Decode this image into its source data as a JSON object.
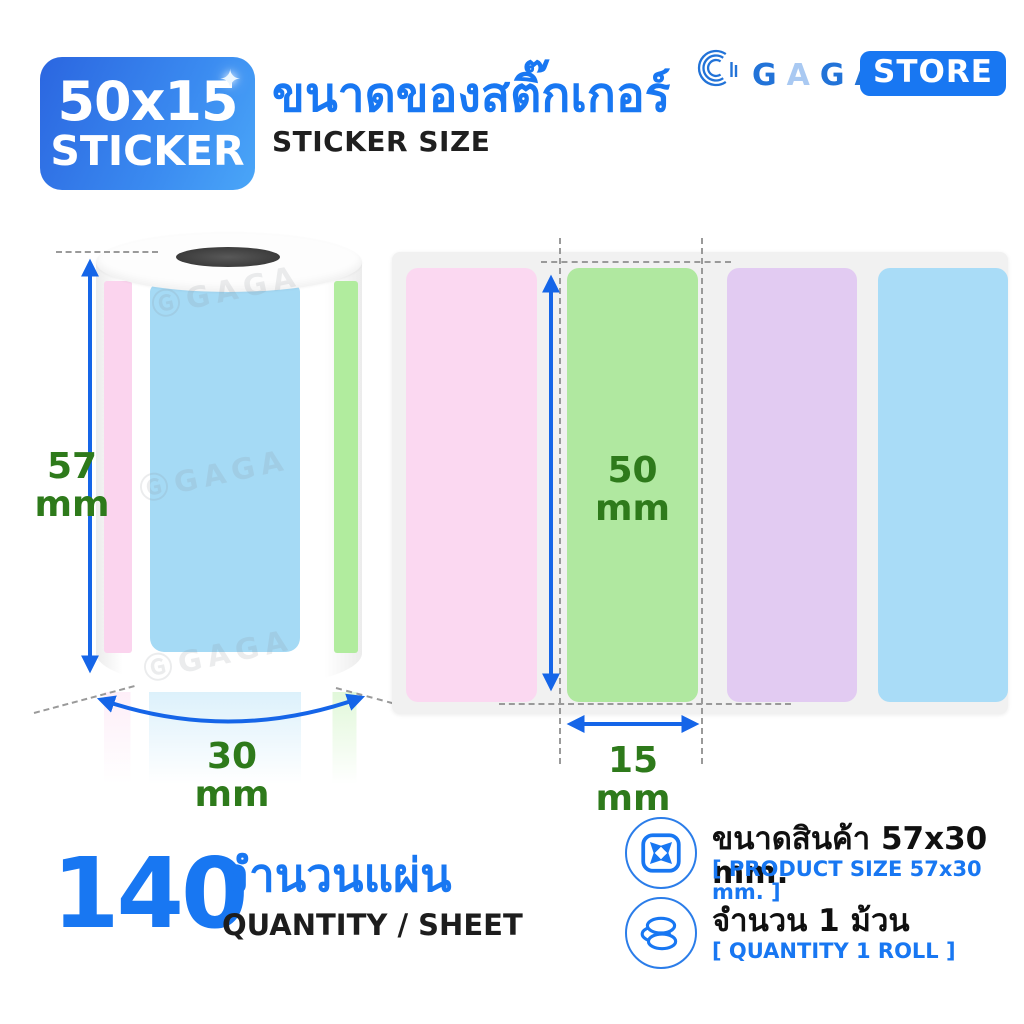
{
  "badge": {
    "size": "50x15",
    "label": "STICKER",
    "sparkle": "✦"
  },
  "header": {
    "title_th": "ขนาดของสติ๊กเกอร์",
    "subtitle_en": "STICKER SIZE"
  },
  "logo": {
    "letters": [
      "G",
      "A",
      "G",
      "A"
    ],
    "letter_colors": [
      "#2273d8",
      "#a9c9f2",
      "#2273d8",
      "#2273d8"
    ],
    "store_label": "STORE"
  },
  "roll": {
    "watermark_mark": "Ⓖ",
    "watermark_text": "GAGA",
    "height": {
      "value": "57",
      "unit": "mm"
    },
    "width": {
      "value": "30",
      "unit": "mm"
    },
    "strips": [
      {
        "name": "pink",
        "color": "#fbd4ee"
      },
      {
        "name": "blue",
        "color": "#a5daf5"
      },
      {
        "name": "green",
        "color": "#b1ec9e"
      }
    ]
  },
  "sheet": {
    "background": "#f1f1f1",
    "sticker_height": {
      "value": "50",
      "unit": "mm"
    },
    "sticker_width": {
      "value": "15",
      "unit": "mm"
    },
    "stickers": [
      {
        "name": "pink",
        "color": "#fbd8f1"
      },
      {
        "name": "green",
        "color": "#b0e8a0"
      },
      {
        "name": "purple",
        "color": "#e2cbf2"
      },
      {
        "name": "blue",
        "color": "#a9dcf7"
      }
    ]
  },
  "quantity": {
    "value": "140",
    "label_th": "จำนวนแผ่น",
    "label_en": "QUANTITY / SHEET"
  },
  "specs": [
    {
      "icon": "expand-icon",
      "text_th": "ขนาดสินค้า 57x30 mm.",
      "text_en": "[ PRODUCT SIZE 57x30 mm. ]"
    },
    {
      "icon": "coins-icon",
      "text_th": "จำนวน 1 ม้วน",
      "text_en": "[ QUANTITY 1 ROLL ]"
    }
  ],
  "colors": {
    "primary_blue": "#1877f2",
    "arrow_blue": "#1565e8",
    "dimension_green": "#2e7a1b",
    "badge_gradient_start": "#2b66e0",
    "badge_gradient_end": "#4aa6f8",
    "text_dark": "#1d1d1d"
  }
}
